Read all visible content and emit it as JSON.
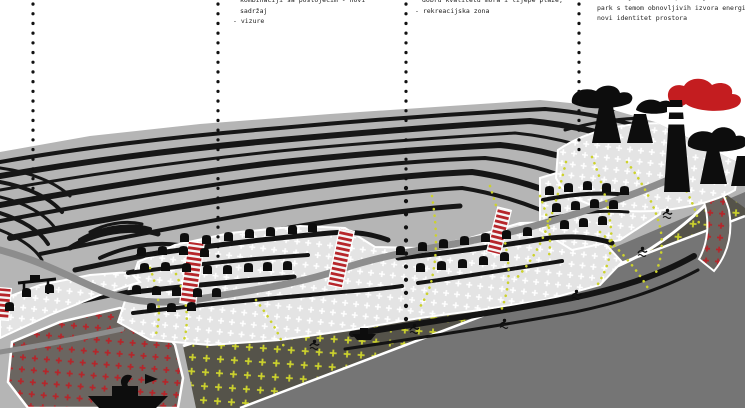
{
  "notes": [
    {
      "lines": [
        "kombinaciji sa postojećim - novi",
        "sadržaj",
        "- vizure"
      ]
    },
    {
      "lines": [
        "dobru kvalitetu mora i lijepe plaže,",
        "- rekreacijska zona"
      ]
    },
    {
      "lines": [
        "industrijske zone - potencijal za tematski",
        "park s temom obnovljivih izvora energije -",
        "novi identitet prostora"
      ]
    }
  ],
  "colors": {
    "background": "#ffffff",
    "terrain_gray": "#b5b5b5",
    "contour_black": "#161616",
    "housing_zone": "#e4e4e4",
    "beach_zone": "#55534a",
    "sea_gray": "#757575",
    "port_zone": "#6b6560",
    "stairs_red": "#b6252a",
    "smoke_red": "#c41d20",
    "trail_yellow": "#ccd22d",
    "road_gray": "#8d8d8d"
  },
  "icons": [
    {
      "name": "house-icon",
      "glyph": "black arch house silhouette"
    },
    {
      "name": "factory-icon",
      "glyph": "black cooling tower with smoke plume"
    },
    {
      "name": "chimney-icon",
      "glyph": "tall banded smokestack"
    },
    {
      "name": "red-smoke-icon",
      "glyph": "red smoke plume"
    },
    {
      "name": "stairs-icon",
      "glyph": "red striped stair ribbon"
    },
    {
      "name": "swimmer-icon",
      "glyph": "black swimmer in water"
    },
    {
      "name": "boat-icon",
      "glyph": "small black boat"
    },
    {
      "name": "ship-icon",
      "glyph": "black cargo ship"
    },
    {
      "name": "crane-icon",
      "glyph": "black gantry crane"
    },
    {
      "name": "leader-line-icon",
      "glyph": "vertical dotted leader line"
    }
  ]
}
